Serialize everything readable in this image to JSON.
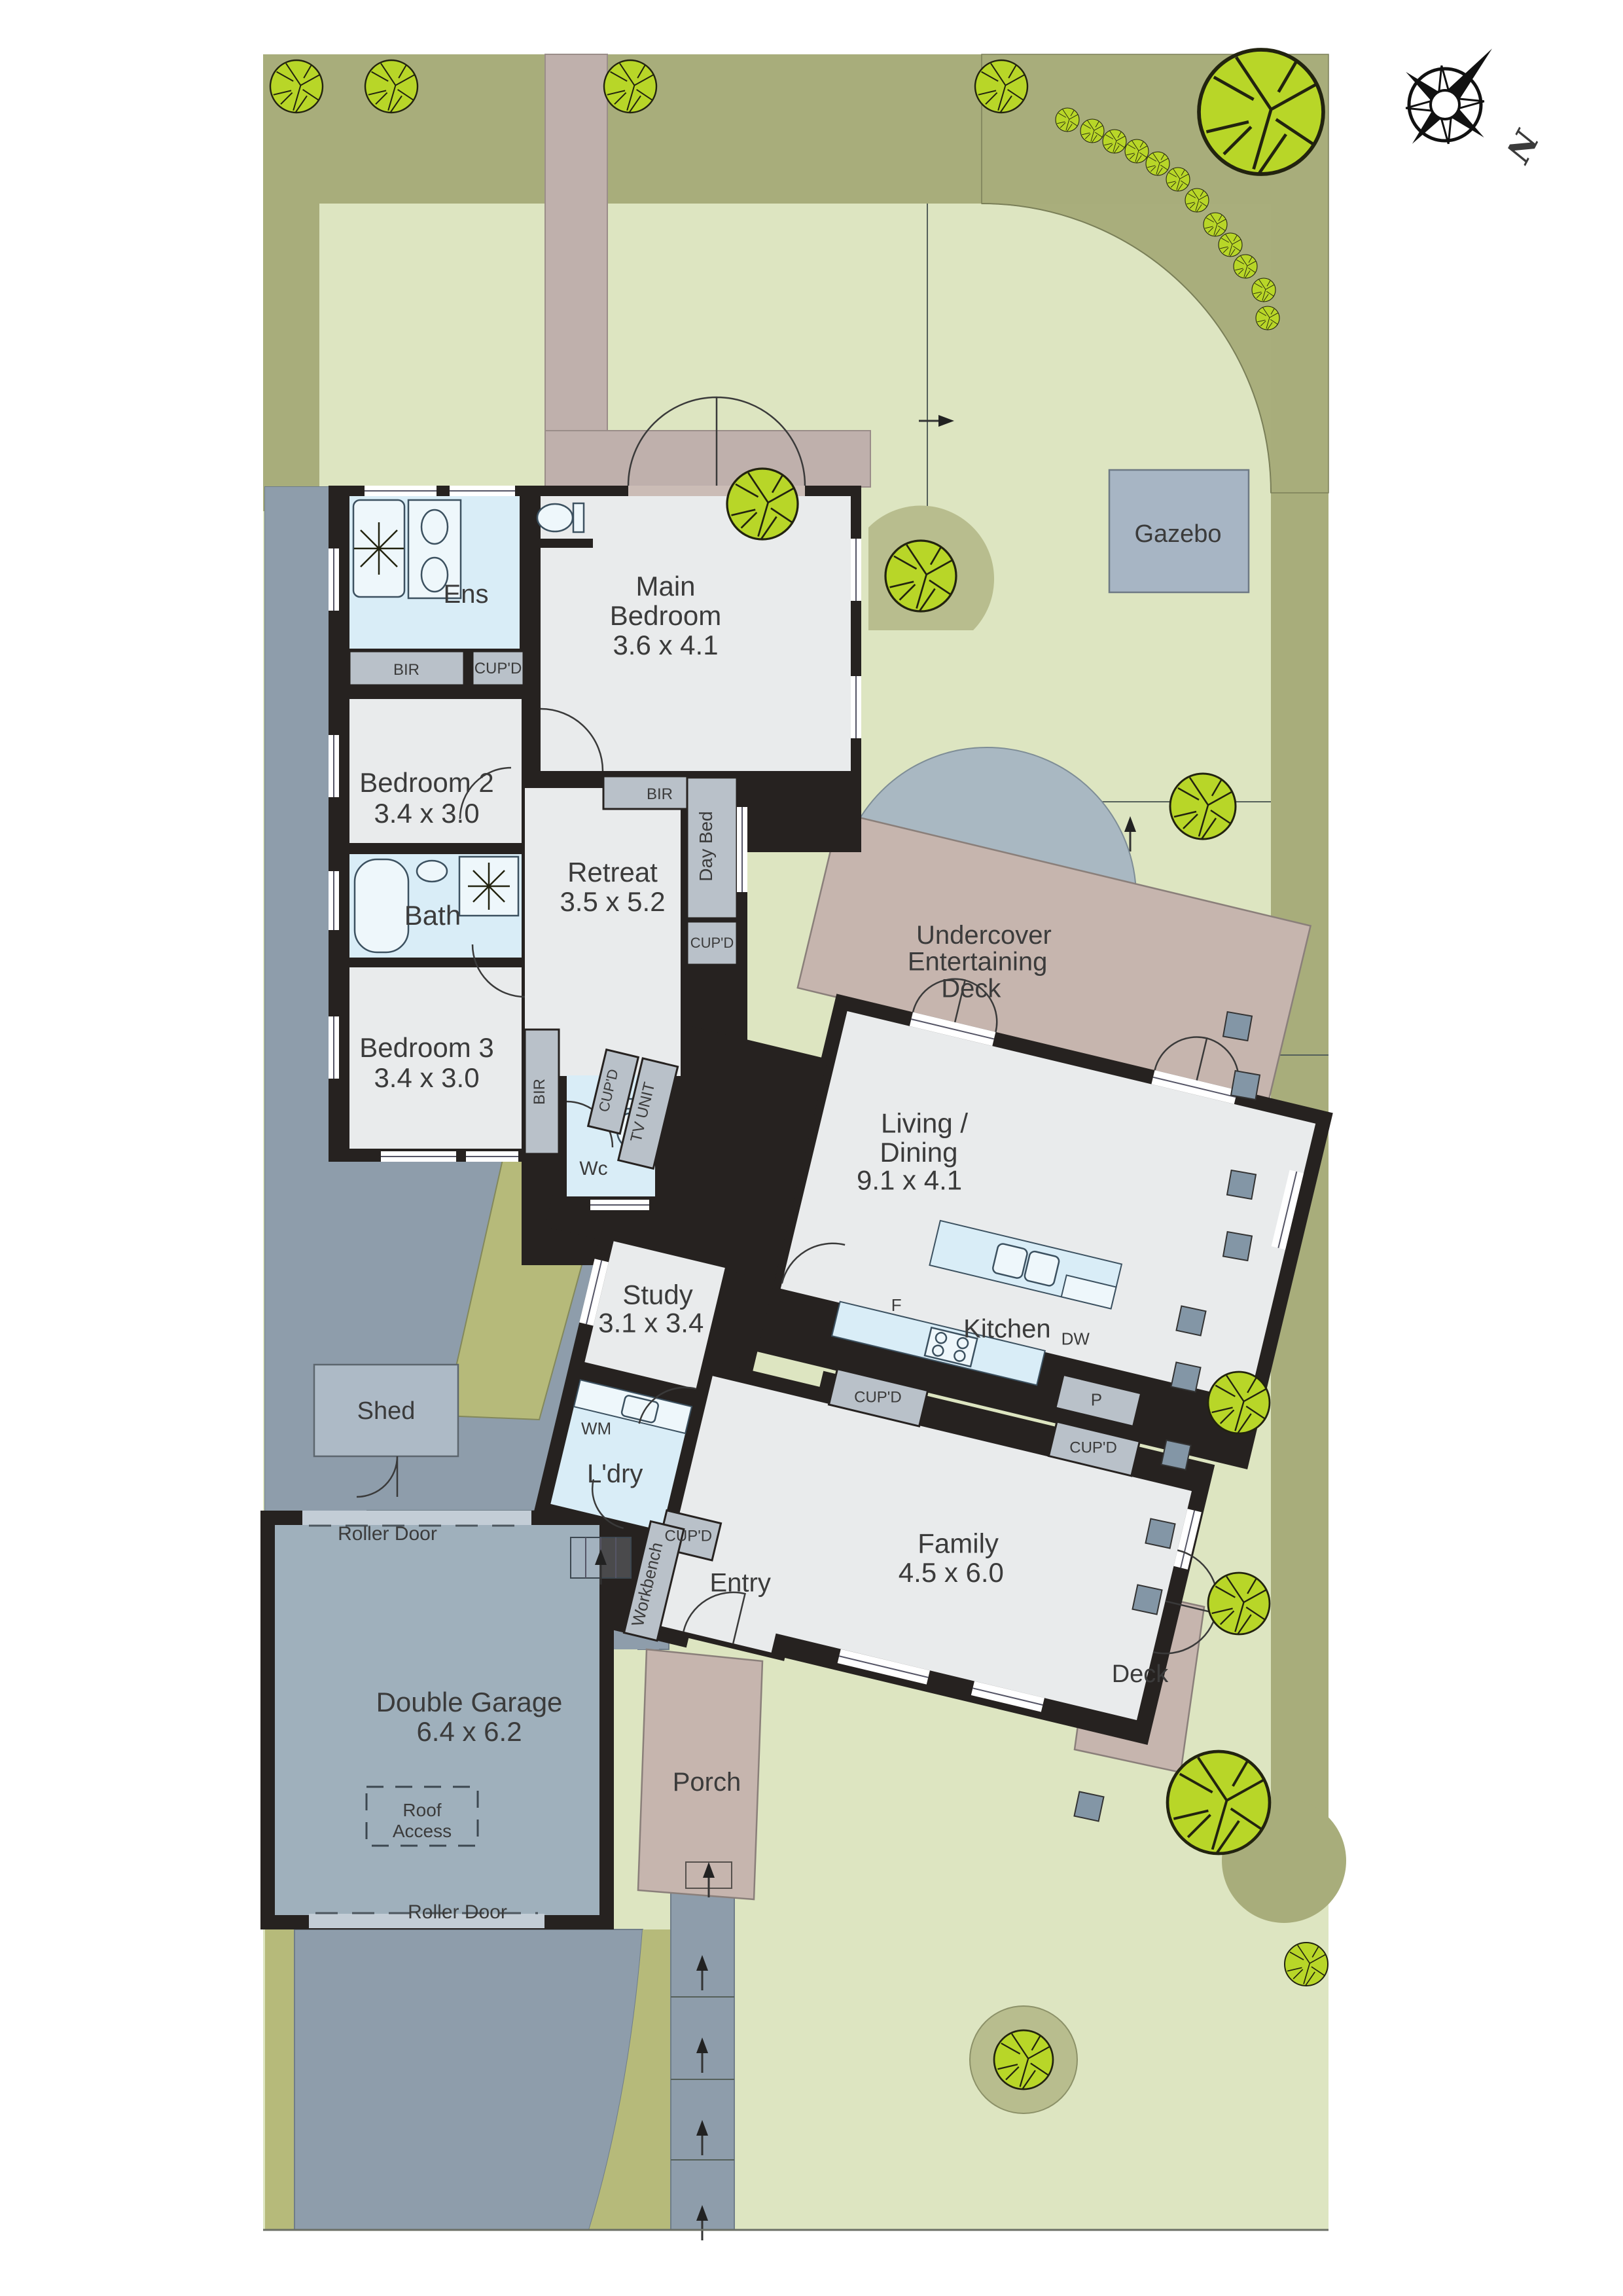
{
  "compass": {
    "north": "N"
  },
  "site": {
    "rooms": {
      "ens": {
        "name": "Ens"
      },
      "main_bedroom": {
        "line1": "Main",
        "line2": "Bedroom",
        "dims": "3.6 x 4.1"
      },
      "bedroom2": {
        "name": "Bedroom 2",
        "dims": "3.4 x 3.0"
      },
      "bedroom3": {
        "name": "Bedroom 3",
        "dims": "3.4 x 3.0"
      },
      "bath": {
        "name": "Bath"
      },
      "wc": {
        "name": "Wc"
      },
      "retreat": {
        "name": "Retreat",
        "dims": "3.5 x 5.2"
      },
      "living_dining": {
        "line1": "Living /",
        "line2": "Dining",
        "dims": "9.1 x 4.1"
      },
      "kitchen": {
        "name": "Kitchen"
      },
      "family": {
        "name": "Family",
        "dims": "4.5 x 6.0"
      },
      "study": {
        "name": "Study",
        "dims": "3.1 x 3.4"
      },
      "laundry": {
        "name": "L'dry"
      },
      "entry": {
        "name": "Entry"
      },
      "garage": {
        "name": "Double Garage",
        "dims": "6.4 x 6.2"
      },
      "porch": {
        "name": "Porch"
      }
    },
    "outdoor": {
      "shed": "Shed",
      "gazebo": "Gazebo",
      "deck": "Deck",
      "undercover": {
        "line1": "Undercover",
        "line2": "Entertaining",
        "line3": "Deck"
      }
    },
    "fixtures": {
      "bir": "BIR",
      "cupd": "CUP'D",
      "day_bed": "Day Bed",
      "tv_unit": "TV UNIT",
      "pantry": "P",
      "fridge": "F",
      "dishwasher": "DW",
      "washing_machine": "WM",
      "workbench": "Workbench",
      "roller_door": "Roller Door",
      "roof_access": {
        "line1": "Roof",
        "line2": "Access"
      }
    },
    "colors": {
      "olive": "#a8ad7b",
      "lawn": "#dde5c1",
      "paving": "#8e9dab",
      "mauve": "#c6b5ae",
      "wall": "#262220",
      "wet_area": "#d9edf7",
      "tree": "#b8d628"
    }
  }
}
